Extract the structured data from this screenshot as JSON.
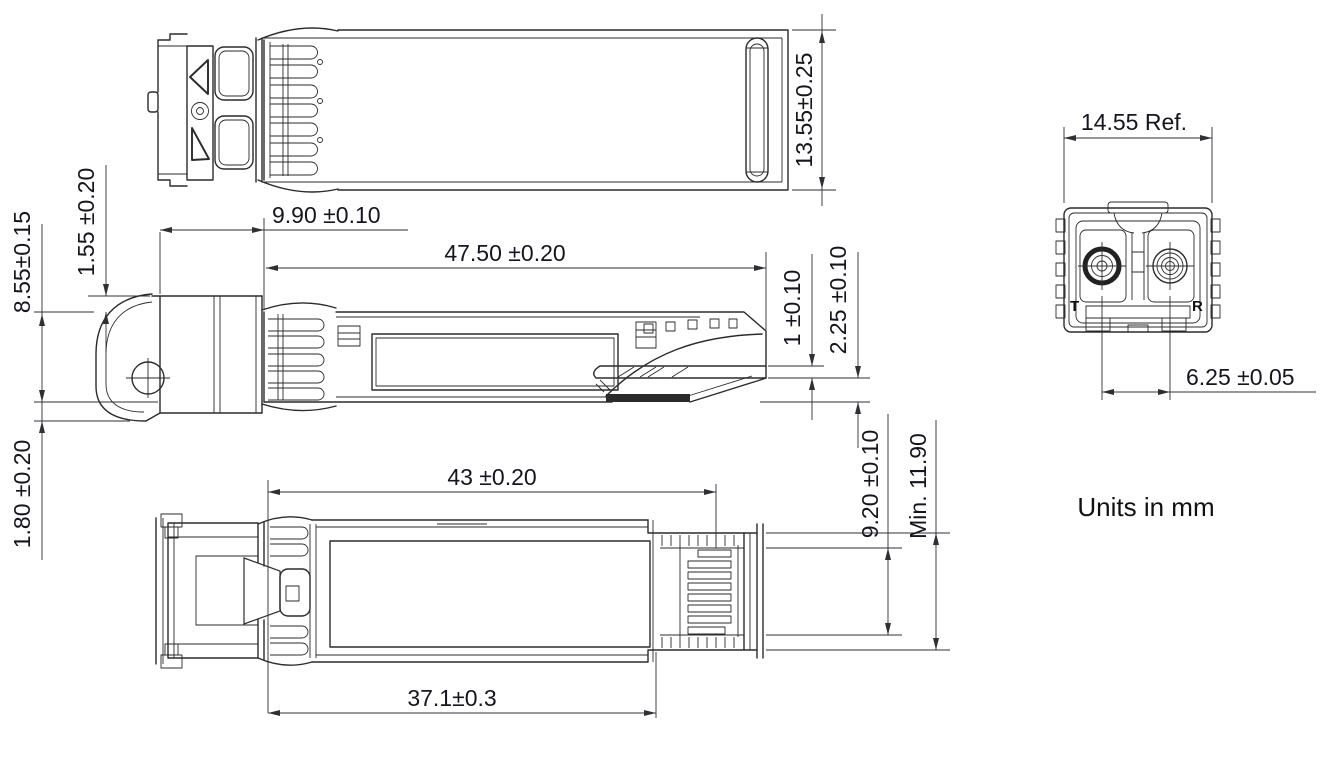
{
  "colors": {
    "line": "#2b2b2b",
    "dimension_line": "#2f2f36",
    "dimension_text": "#15151f",
    "background": "#ffffff"
  },
  "dimensions": {
    "module_height": "13.55±0.25",
    "nose_length": "9.90 ±0.10",
    "body_length": "47.50 ±0.20",
    "body_height": "8.55±0.15",
    "gasket_step": "1.55 ±0.20",
    "bail_offset": "1.80 ±0.20",
    "pcb_thickness": "1 ±0.10",
    "pcb_clearance": "2.25 ±0.10",
    "connector_width": "9.20 ±0.10",
    "min_width": "Min. 11.90",
    "cage_length": "43 ±0.20",
    "label_length": "37.1±0.3",
    "front_width": "14.55 Ref.",
    "port_pitch": "6.25 ±0.05"
  },
  "labels": {
    "transmit_port": "T",
    "receive_port": "R",
    "units_note": "Units in mm"
  }
}
